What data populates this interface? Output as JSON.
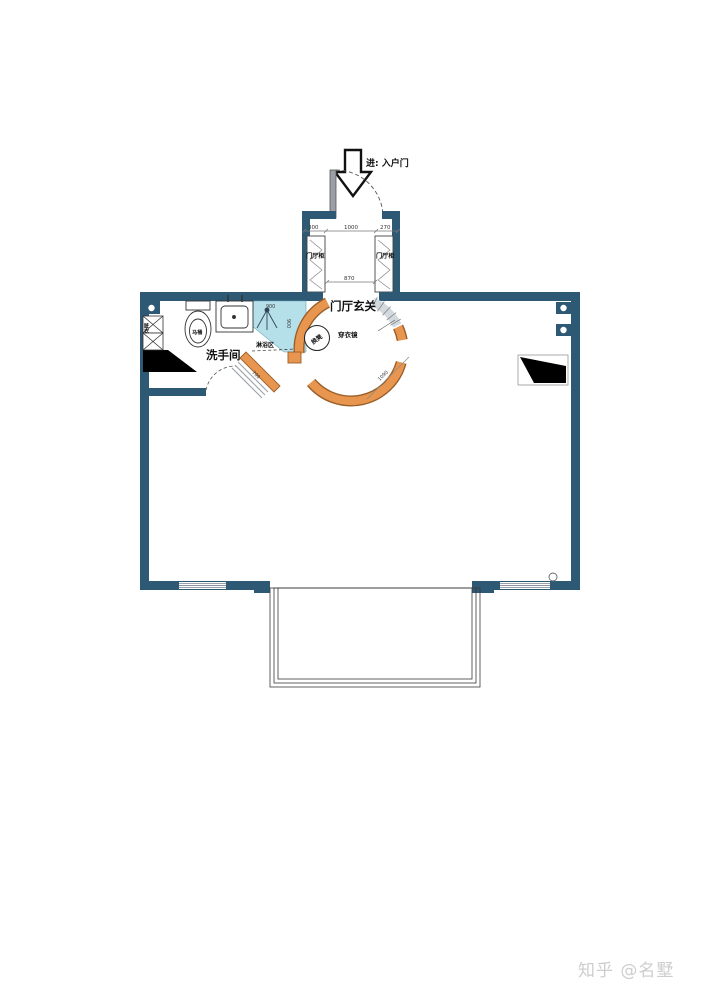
{
  "watermark": {
    "text": "知乎 @名墅"
  },
  "colors": {
    "wall": "#2e5975",
    "accent_orange": "#e8964f",
    "orange_outline": "#9a5f28",
    "shower_fill": "#b5dfe9",
    "window_line": "#8a949c",
    "watermark_gray": "#cdcdcd"
  },
  "plan": {
    "entry": {
      "label": "进: 入户门"
    },
    "hallway": {
      "cabinet_left": "门厅柜",
      "cabinet_right": "门厅柜",
      "dim_left": "300",
      "dim_mid": "1000",
      "dim_right": "270",
      "dim_opening": "870"
    },
    "foyer": {
      "label": "门厅玄关",
      "mirror": "穿衣镜",
      "stool": "换凳",
      "dim_radius": "1090"
    },
    "bathroom": {
      "label": "洗手间",
      "shower": "淋浴区",
      "toilet": "马桶",
      "hamper": "脏衣",
      "dim_shower_w": "900",
      "dim_shower_h": "900",
      "dim_door": "700"
    }
  }
}
